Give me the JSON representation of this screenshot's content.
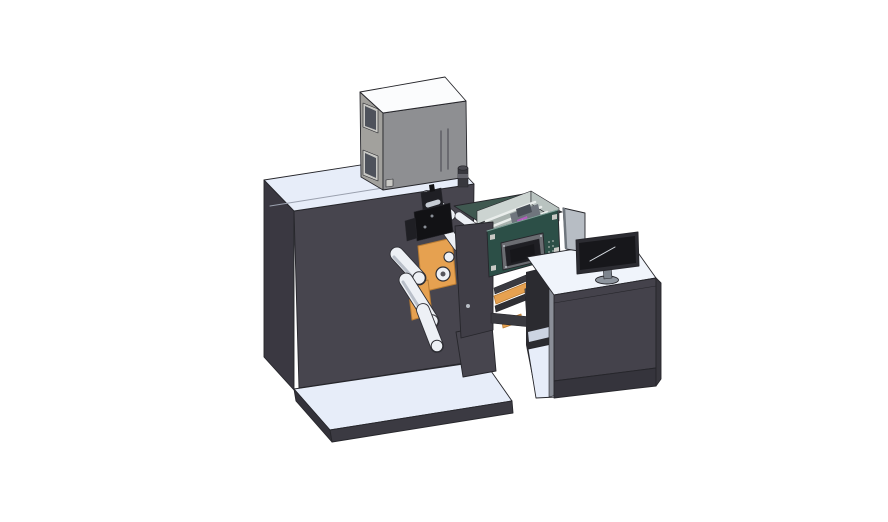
{
  "scene": {
    "alt_text": "Isometric 3D CAD rendering of an industrial roll label printing machine: large dark main cabinet with gray electrical control box on top, orange unwinder frames with white web rollers and black print head, transparent print enclosure with teal control panel and small display, and an operator desk with computer monitor, all standing on light base platforms on a white background."
  },
  "colors": {
    "background": "#ffffff",
    "edge": "#26262b",
    "surfaceLight": "#e7edf9",
    "surfaceWhite": "#f0f4fb",
    "machineFront": "#47454e",
    "machineSide": "#3a3841",
    "platformFront": "#3b3a42",
    "platformSide": "#33323a",
    "cabinetTop": "#fbfcfd",
    "cabinetSide": "#a2a19d",
    "cabinetFront": "#8e8f92",
    "windowDark": "#4e525b",
    "windowFrame": "#c9c9c5",
    "slotDark": "#5e5e64",
    "knobBody": "#38383e",
    "knobBand": "#63636b",
    "knobTop": "#4a4a50",
    "deckTeal": "#3f5850",
    "tealPanel": "#2c4f47",
    "tealPanelEdge": "#7fa39a",
    "wallL": "#ccd4d1",
    "wallR": "#b9c3c0",
    "floorGreen": "#a9b3af",
    "stripLight": "#e9edeb",
    "innerGray": "#6f757d",
    "innerDark": "#494f57",
    "magenta": "#b55cbe",
    "magentaLight": "#d98fd9",
    "orange": "#e6a150",
    "orangeEdge": "#b97c33",
    "rollerLight": "#edf0f5",
    "rollerShade": "#b9bfc9",
    "rollerDark": "#2e2e34",
    "rollerHub": "#55555c",
    "printBlack": "#121215",
    "printBlack2": "#1f1f24",
    "printGray": "#8a8f97",
    "silver": "#c6ccd4",
    "pillar": "#403e47",
    "boltLight": "#b9bec6",
    "chuteDark": "#3a3a40",
    "deviceGray": "#6b6d72",
    "deviceDot": "#3a3a3e",
    "bracketDark": "#2f2f34",
    "interiorDark": "#2b2b30",
    "shelfLight": "#ccd4e2",
    "pillarEdge": "#8b8f98",
    "deskFront": "#44424b",
    "deskSide": "#38373e",
    "deskTrim": "#35343c",
    "panelGray": "#b7bdc4",
    "panelEdge": "#6f767d",
    "monitorBezel": "#2c2c32",
    "monitorScreen": "#17171b",
    "glint": "#d6dbe1",
    "standGray": "#8e959e",
    "neckGray": "#7d848d",
    "seamLight": "#9aa0ae"
  }
}
